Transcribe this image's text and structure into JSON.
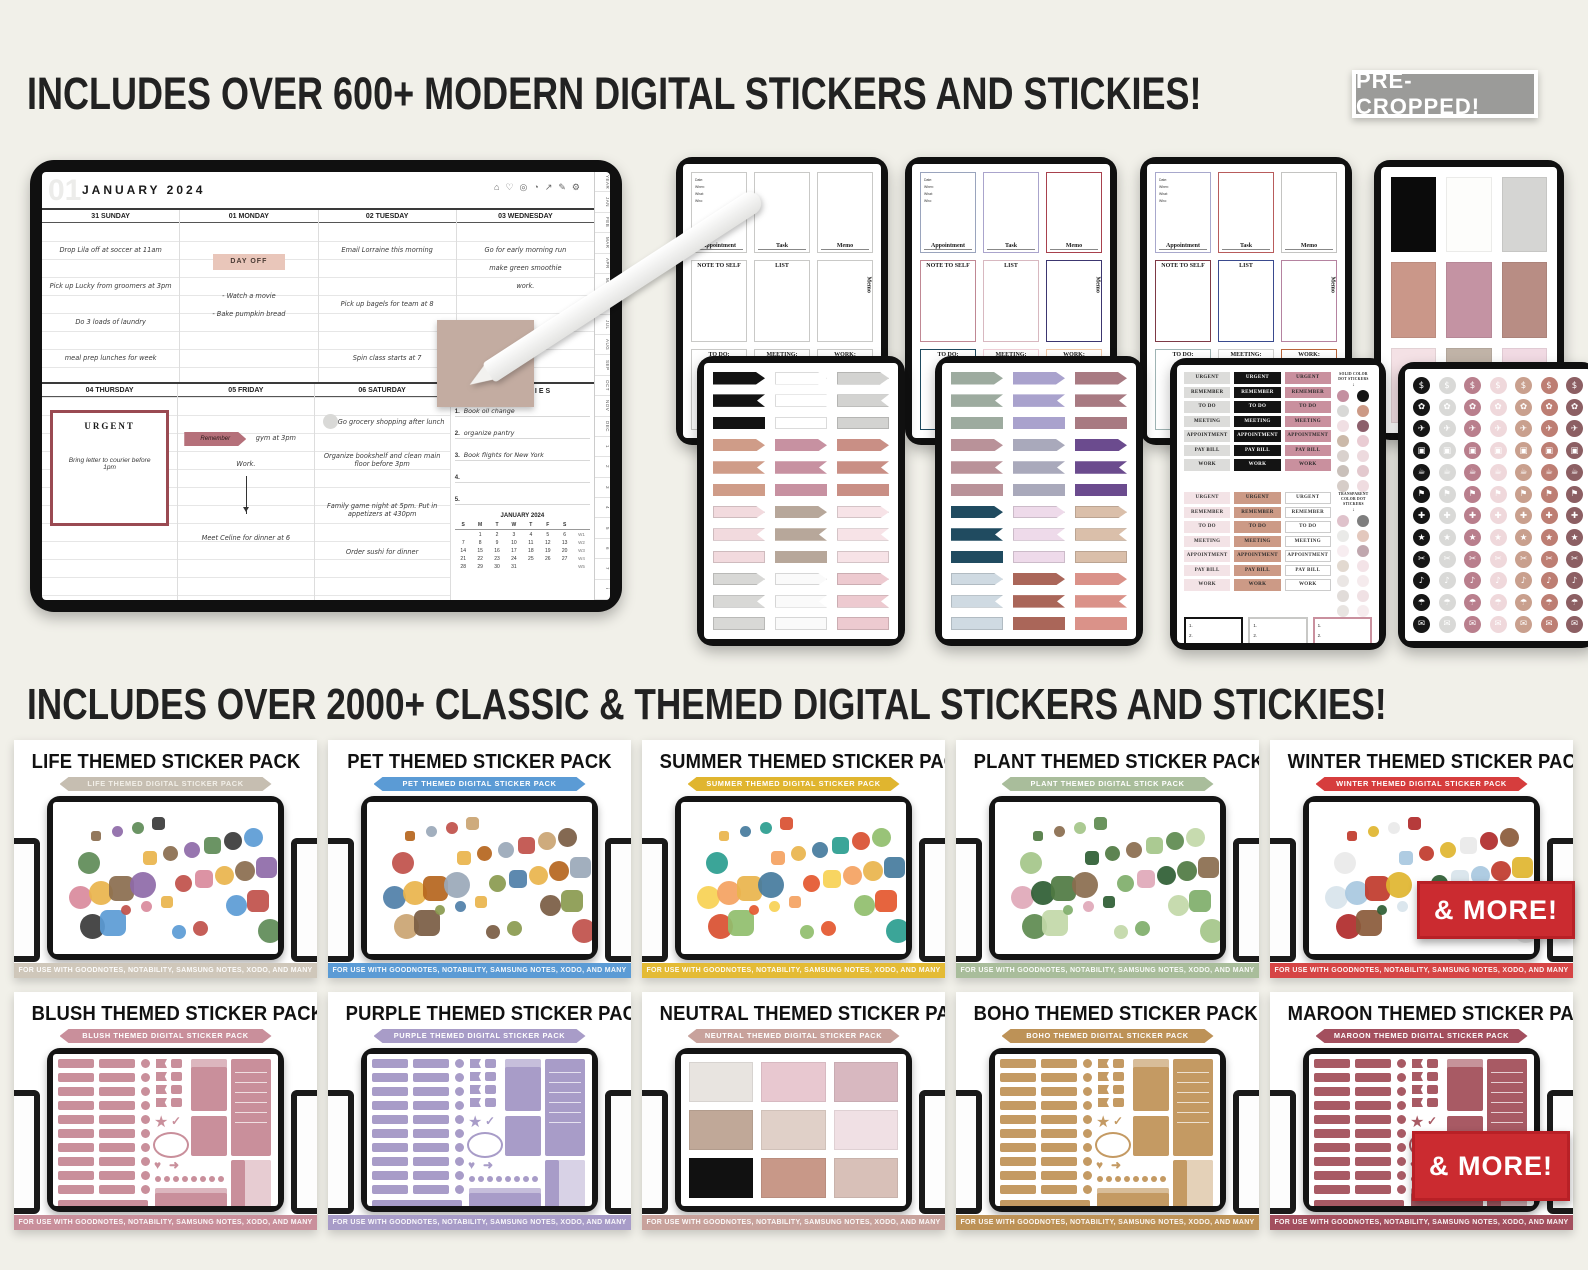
{
  "header": {
    "title": "INCLUDES OVER 600+ MODERN DIGITAL STICKERS AND STICKIES!",
    "badge": "PRE- CROPPED!"
  },
  "section2": {
    "title": "INCLUDES OVER 2000+ CLASSIC & THEMED DIGITAL STICKERS AND STICKIES!"
  },
  "hero": {
    "planner": {
      "month_num": "01",
      "month_title": "JANUARY 2024",
      "toolbar_icons": [
        {
          "name": "home-icon",
          "glyph": "⌂"
        },
        {
          "name": "heart-icon",
          "glyph": "♡"
        },
        {
          "name": "headphones-icon",
          "glyph": "◎"
        },
        {
          "name": "timer-icon",
          "glyph": "◔"
        },
        {
          "name": "trend-icon",
          "glyph": "↗"
        },
        {
          "name": "pen-icon",
          "glyph": "✎"
        },
        {
          "name": "settings-icon",
          "glyph": "⚙"
        }
      ],
      "side_tabs": [
        "YEAR",
        "JAN",
        "FEB",
        "MAR",
        "APR",
        "MAY",
        "JUN",
        "JUL",
        "AUG",
        "SEP",
        "OCT",
        "NOV",
        "DEC",
        "1",
        "2",
        "3",
        "4",
        "5",
        "6",
        "7",
        "i"
      ],
      "days": [
        {
          "label": "31 SUNDAY",
          "notes": [
            "Drop Lila off at soccer at 11am",
            "Pick up Lucky from groomers at 3pm",
            "Do 3 loads of laundry",
            "meal prep lunches for week"
          ]
        },
        {
          "label": "01 MONDAY",
          "sticker": "DAY OFF",
          "notes": [
            "- Watch a movie",
            "- Bake pumpkin bread"
          ]
        },
        {
          "label": "02 TUESDAY",
          "notes": [
            "Email Lorraine this morning",
            "Pick up bagels for team at 8",
            "Spin class starts at 7"
          ]
        },
        {
          "label": "03 WEDNESDAY",
          "notes": [
            "Go for early morning run",
            "make green smoothie",
            "work."
          ]
        },
        {
          "label": "04 THURSDAY",
          "urgent_title": "URGENT",
          "urgent_body": "Bring letter to courier before 1pm"
        },
        {
          "label": "05 FRIDAY",
          "flag": "Remember",
          "notes": [
            "gym at 3pm",
            "Work.",
            "Meet Celine for dinner at 6"
          ]
        },
        {
          "label": "06 SATURDAY",
          "notes": [
            "Go grocery shopping after lunch",
            "Organize bookshelf and clean main floor before 3pm",
            "Family game night at 5pm. Put in appetizers at 430pm",
            "Order sushi for dinner"
          ]
        }
      ],
      "priorities": {
        "title": "PRIORITIES",
        "items": [
          "Book oil change",
          "organize pantry",
          "Book flights for New York",
          "",
          ""
        ]
      },
      "mini_cal": {
        "title": "JANUARY 2024",
        "dow": [
          "S",
          "M",
          "T",
          "W",
          "T",
          "F",
          "S",
          ""
        ],
        "weeks": [
          [
            "",
            "1",
            "2",
            "3",
            "4",
            "5",
            "6",
            "W1"
          ],
          [
            "7",
            "8",
            "9",
            "10",
            "11",
            "12",
            "13",
            "W2"
          ],
          [
            "14",
            "15",
            "16",
            "17",
            "18",
            "19",
            "20",
            "W3"
          ],
          [
            "21",
            "22",
            "23",
            "24",
            "25",
            "26",
            "27",
            "W4"
          ],
          [
            "28",
            "29",
            "30",
            "31",
            "",
            "",
            "",
            "W5"
          ]
        ]
      }
    },
    "template_sheet": {
      "cells": [
        "Appointment",
        "Task",
        "Memo",
        "NOTE TO SELF",
        "LIST",
        "Memo",
        "TO DO:",
        "MEETING:",
        "WORK:"
      ],
      "fields": [
        "Date:",
        "When:",
        "What:",
        "Who:"
      ],
      "tablets": [
        {
          "borders": [
            "#c9c9c7",
            "#c9c9c7",
            "#c9c9c7",
            "#c9c9c7",
            "#c9c9c7",
            "#c9c9c7",
            "#c9c9c7",
            "#c9c9c7",
            "#c9c9c7"
          ]
        },
        {
          "borders": [
            "#9aa4bd",
            "#aaa4cc",
            "#a8414d",
            "#c08894",
            "#d8b8c0",
            "#3c3670",
            "#1f4a5f",
            "#f0d0d8",
            "#f0c8a8"
          ]
        },
        {
          "borders": [
            "#a8a8cc",
            "#b85c5c",
            "#c4c4c2",
            "#7e3a46",
            "#3a4a8e",
            "#b583a0",
            "#9fb4b4",
            "#d0d0ce",
            "#b8643a"
          ]
        }
      ]
    },
    "color_squares": [
      "#0b0b0b",
      "#fdfdfb",
      "#d5d5d3",
      "#ca9789",
      "#c493a3",
      "#b88d84",
      "#f4e1e5",
      "#c0b3a7",
      "#f1dae3"
    ],
    "flag_tablets": [
      {
        "groups": [
          [
            "#131313",
            "#ffffff",
            "#d3d3d1"
          ],
          [
            "#cf9c88",
            "#c791a1",
            "#c98f85"
          ],
          [
            "#f2dade",
            "#b7a79a",
            "#f7e3e7"
          ],
          [
            "#d8d8d6",
            "#fafafa",
            "#edcad0"
          ]
        ]
      },
      {
        "groups": [
          [
            "#9dab9f",
            "#a9a2cd",
            "#a87a82"
          ],
          [
            "#b99299",
            "#a9a9bb",
            "#6b4b8e"
          ],
          [
            "#204b60",
            "#eedaea",
            "#dabfaa"
          ],
          [
            "#cfdae2",
            "#aa6659",
            "#da9289"
          ]
        ]
      }
    ],
    "labels_sheet": {
      "labels": [
        "URGENT",
        "REMEMBER",
        "TO DO",
        "MEETING",
        "APPOINTMENT",
        "PAY BILL",
        "WORK"
      ],
      "solid_note": "SOLID COLOR DOT STICKERS",
      "transparent_note": "TRANSPARENT COLOR DOT STICKERS",
      "set1": [
        {
          "bg": "#dcdcda",
          "fg": "#222222"
        },
        {
          "bg": "#141414",
          "fg": "#ffffff"
        },
        {
          "bg": "#c9909e",
          "fg": "#2a2a2a"
        }
      ],
      "set2": [
        {
          "bg": "#f3e3e6",
          "fg": "#333333"
        },
        {
          "bg": "#cc9a86",
          "fg": "#2a2a2a"
        },
        {
          "bg": "#ffffff",
          "fg": "#333333",
          "bd": "#cccccc"
        }
      ],
      "dot_colors": [
        "#c48fa0",
        "#141414",
        "#d8d8d6",
        "#cc9a86",
        "#f0dfe3",
        "#8c5f6b",
        "#cbb9a9",
        "#e9ccd3",
        "#d9d1cd",
        "#eddade",
        "#c9c0ba",
        "#e3c9ce",
        "#d6cdc8",
        "#efdce0"
      ],
      "box_borders": [
        "#141414",
        "#c8c8c6",
        "#c9909e"
      ],
      "box_lines": [
        "1.",
        "2.",
        "3."
      ]
    },
    "icons_sheet": {
      "icon_names": [
        "dollar-icon",
        "paw-icon",
        "airplane-icon",
        "luggage-icon",
        "basket-icon",
        "utensils-icon",
        "health-icon",
        "star-icon",
        "fitness-icon",
        "drinks-icon",
        "coffee-icon",
        "cake-icon"
      ],
      "glyphs": [
        "$",
        "✿",
        "✈",
        "▣",
        "☕",
        "⚑",
        "✚",
        "★",
        "✂",
        "♪",
        "☂",
        "✉"
      ],
      "colors": [
        "#161616",
        "#d9d9d7",
        "#b97f8d",
        "#efd8db",
        "#c9a08e",
        "#bd7e73",
        "#8c5f63"
      ]
    }
  },
  "packs": {
    "footer": "FOR USE WITH GOODNOTES, NOTABILITY, SAMSUNG NOTES, XODO, AND MANY MORE!",
    "more_badge_label": "& MORE!",
    "row1": [
      {
        "title": "LIFE THEMED STICKER PACK",
        "banner": "LIFE THEMED DIGITAL STICKER PACK",
        "banner_color": "#c6beb1",
        "banner_text": "#f2efe8",
        "bar_color": "#cfc7ba",
        "palette": [
          "#8a6d4e",
          "#c0504a",
          "#5e8b57",
          "#e9b44c",
          "#5b9bd5",
          "#8e6aa8",
          "#d98a9c",
          "#3a3a3a"
        ]
      },
      {
        "title": "PET THEMED STICKER PACK",
        "banner": "PET THEMED DIGITAL STICKER PACK",
        "banner_color": "#5b9bd5",
        "bar_color": "#5b9bd5",
        "palette": [
          "#b5651d",
          "#8a9a4f",
          "#c0504a",
          "#e9b44c",
          "#7a5c43",
          "#9aa8b8",
          "#4f7fa8",
          "#caa472"
        ]
      },
      {
        "title": "SUMMER THEMED STICKER PACK",
        "banner": "SUMMER THEMED DIGITAL STICKER PACK",
        "banner_color": "#e0b52f",
        "bar_color": "#e4bb35",
        "palette": [
          "#e9b44c",
          "#e4572e",
          "#2a9d8f",
          "#f4a261",
          "#90be6d",
          "#457b9d",
          "#f7d154",
          "#d94f30"
        ]
      },
      {
        "title": "PLANT THEMED STICKER PACK",
        "banner": "PLANT THEMED DIGITAL STICK PACK",
        "banner_color": "#a9bd9b",
        "bar_color": "#a9bd9b",
        "palette": [
          "#4f7a42",
          "#7fae6a",
          "#a4c689",
          "#2e5d33",
          "#c2d8a8",
          "#8a6d4e",
          "#e0a8b8",
          "#5d8a4f"
        ]
      },
      {
        "title": "WINTER THEMED STICKER PACK",
        "banner": "WINTER THEMED DIGITAL STICKER PACK",
        "banner_color": "#d63d3d",
        "bar_color": "#d64545",
        "palette": [
          "#c0392b",
          "#2e5d33",
          "#e9e9e9",
          "#a8c8e0",
          "#8a5a3a",
          "#e0b52f",
          "#d8e4ec",
          "#b02a2a"
        ]
      }
    ],
    "row2": [
      {
        "title": "BLUSH THEMED STICKER PACK",
        "banner": "BLUSH THEMED DIGITAL STICKER PACK",
        "banner_color": "#c98f9b",
        "bar_color": "#c98f9b",
        "sheet_color": "#c98f9b"
      },
      {
        "title": "PURPLE THEMED STICKER PACK",
        "banner": "PURPLE THEMED DIGITAL STICKER PACK",
        "banner_color": "#a89cc8",
        "bar_color": "#a89cc8",
        "sheet_color": "#a89cc8"
      },
      {
        "title": "NEUTRAL THEMED STICKER PACK",
        "banner": "NEUTRAL THEMED DIGITAL STICKER PACK",
        "banner_color": "#c8a29c",
        "bar_color": "#c8a29c",
        "palette": [
          "#e8e4e0",
          "#e8c8d0",
          "#d8b8c0",
          "#c0a898",
          "#e0d0c8",
          "#f0e0e4",
          "#111111",
          "#c89888",
          "#d8c0b8"
        ]
      },
      {
        "title": "BOHO THEMED STICKER PACK",
        "banner": "BOHO THEMED DIGITAL STICKER PACK",
        "banner_color": "#bd9257",
        "bar_color": "#bd9257",
        "sheet_color": "#c49a63"
      },
      {
        "title": "MAROON THEMED STICKER PACK",
        "banner": "MAROON THEMED DIGITAL STICKER PACK",
        "banner_color": "#a34f5e",
        "bar_color": "#a34f5e",
        "sheet_color": "#a85a64"
      }
    ]
  }
}
